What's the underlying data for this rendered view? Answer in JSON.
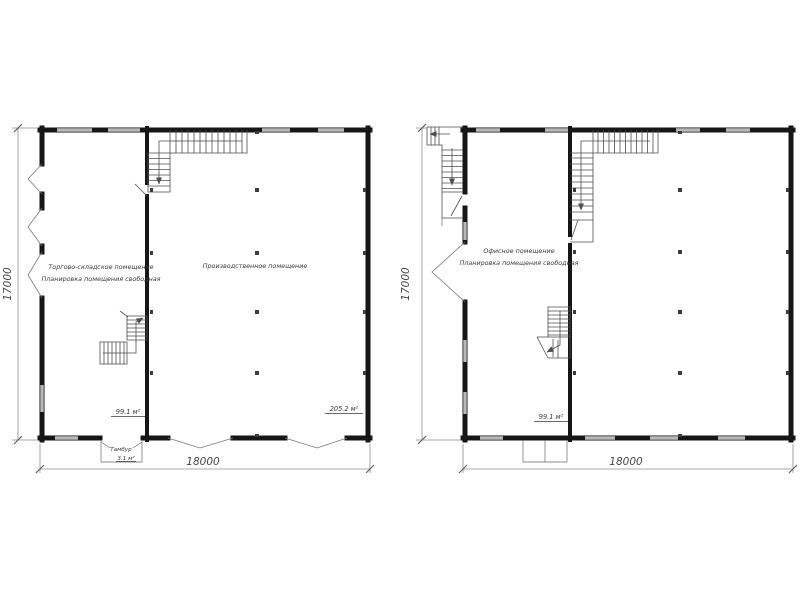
{
  "palette": {
    "background": "#ffffff",
    "wall_color": "#161616",
    "window_color": "#b8b8b8",
    "line_color": "#4f4f4f",
    "dimension_color": "#8f8f8f",
    "text_color": "#3a3a3a"
  },
  "left_plan": {
    "room1_name_line1": "Торгово-складское помещение",
    "room1_name_line2": "Планировка помещения свободная",
    "room1_area": "99.1 м²",
    "room2_name": "Производственное помещение",
    "room2_area": "205.2 м²",
    "vestibule_label": "Тамбур",
    "vestibule_area": "3.1 м²",
    "height_dim": "17000",
    "width_dim": "18000"
  },
  "right_plan": {
    "room1_name_line1": "Офисное помещение",
    "room1_name_line2": "Планировка помещения свободная",
    "room1_area": "99.1 м²",
    "height_dim": "17000",
    "width_dim": "18000"
  }
}
